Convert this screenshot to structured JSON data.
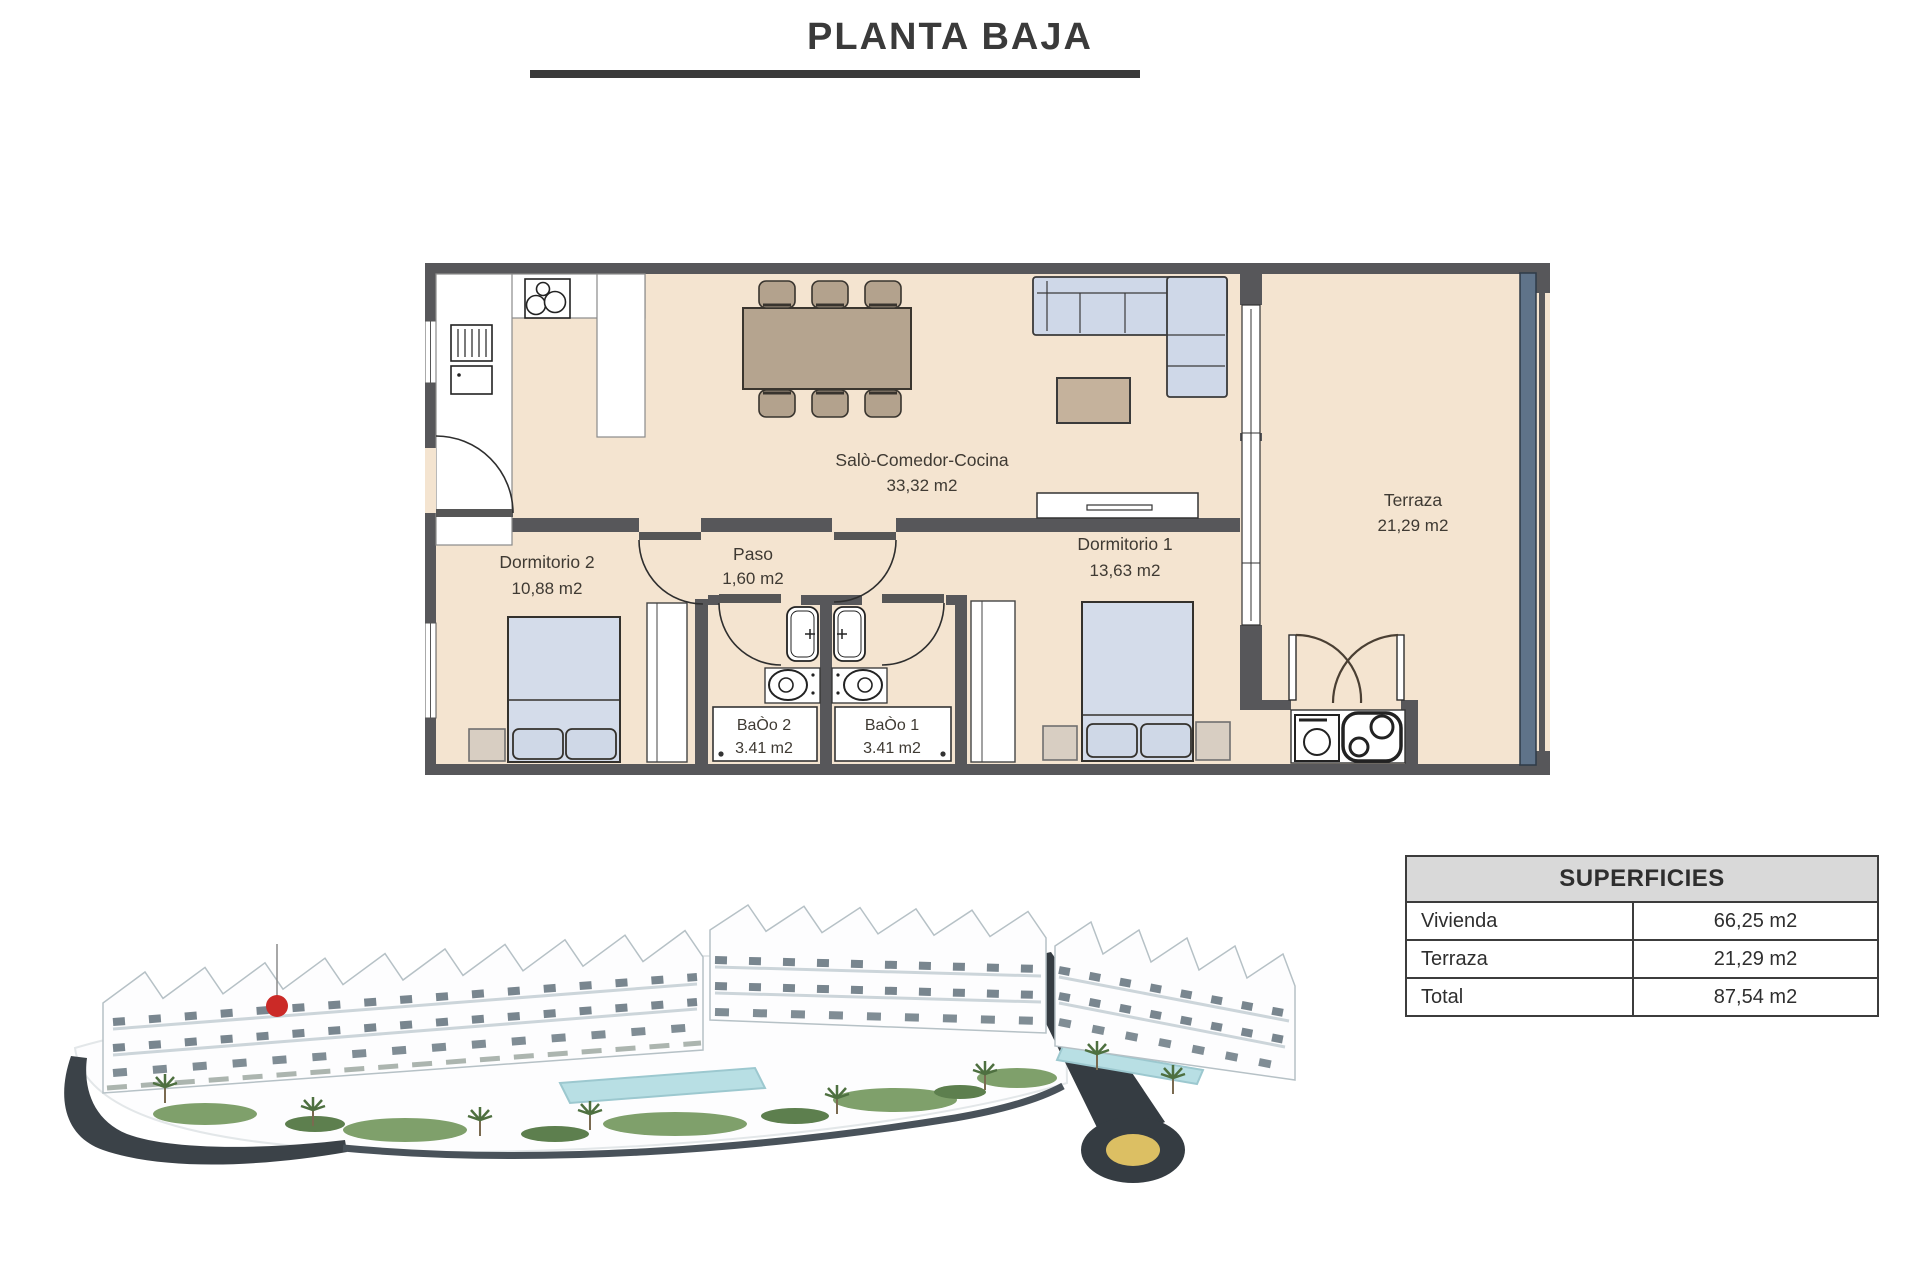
{
  "page": {
    "title": "PLANTA BAJA"
  },
  "floorplan": {
    "rooms": [
      {
        "id": "salon",
        "name": "Salò-Comedor-Cocina",
        "area": "33,32 m2"
      },
      {
        "id": "terraza",
        "name": "Terraza",
        "area": "21,29 m2"
      },
      {
        "id": "dormitorio2",
        "name": "Dormitorio 2",
        "area": "10,88 m2"
      },
      {
        "id": "paso",
        "name": "Paso",
        "area": "1,60 m2"
      },
      {
        "id": "dormitorio1",
        "name": "Dormitorio 1",
        "area": "13,63 m2"
      },
      {
        "id": "bano2",
        "name": "BaÒo 2",
        "area": "3.41 m2"
      },
      {
        "id": "bano1",
        "name": "BaÒo 1",
        "area": "3.41 m2"
      }
    ]
  },
  "superficies": {
    "title": "SUPERFICIES",
    "rows": [
      {
        "label": "Vivienda",
        "value": "66,25 m2"
      },
      {
        "label": "Terraza",
        "value": "21,29 m2"
      },
      {
        "label": "Total",
        "value": "87,54 m2"
      }
    ]
  },
  "colors": {
    "wall": "#57575a",
    "floor": "#f4e4d0",
    "glass_railing": "#5f7389",
    "fabric_blue": "#cfd8e8",
    "wood_tan": "#b5a48f",
    "marker_red": "#cb2a27",
    "roundabout_yellow": "#dcbf63",
    "road_dark": "#3b4248"
  }
}
